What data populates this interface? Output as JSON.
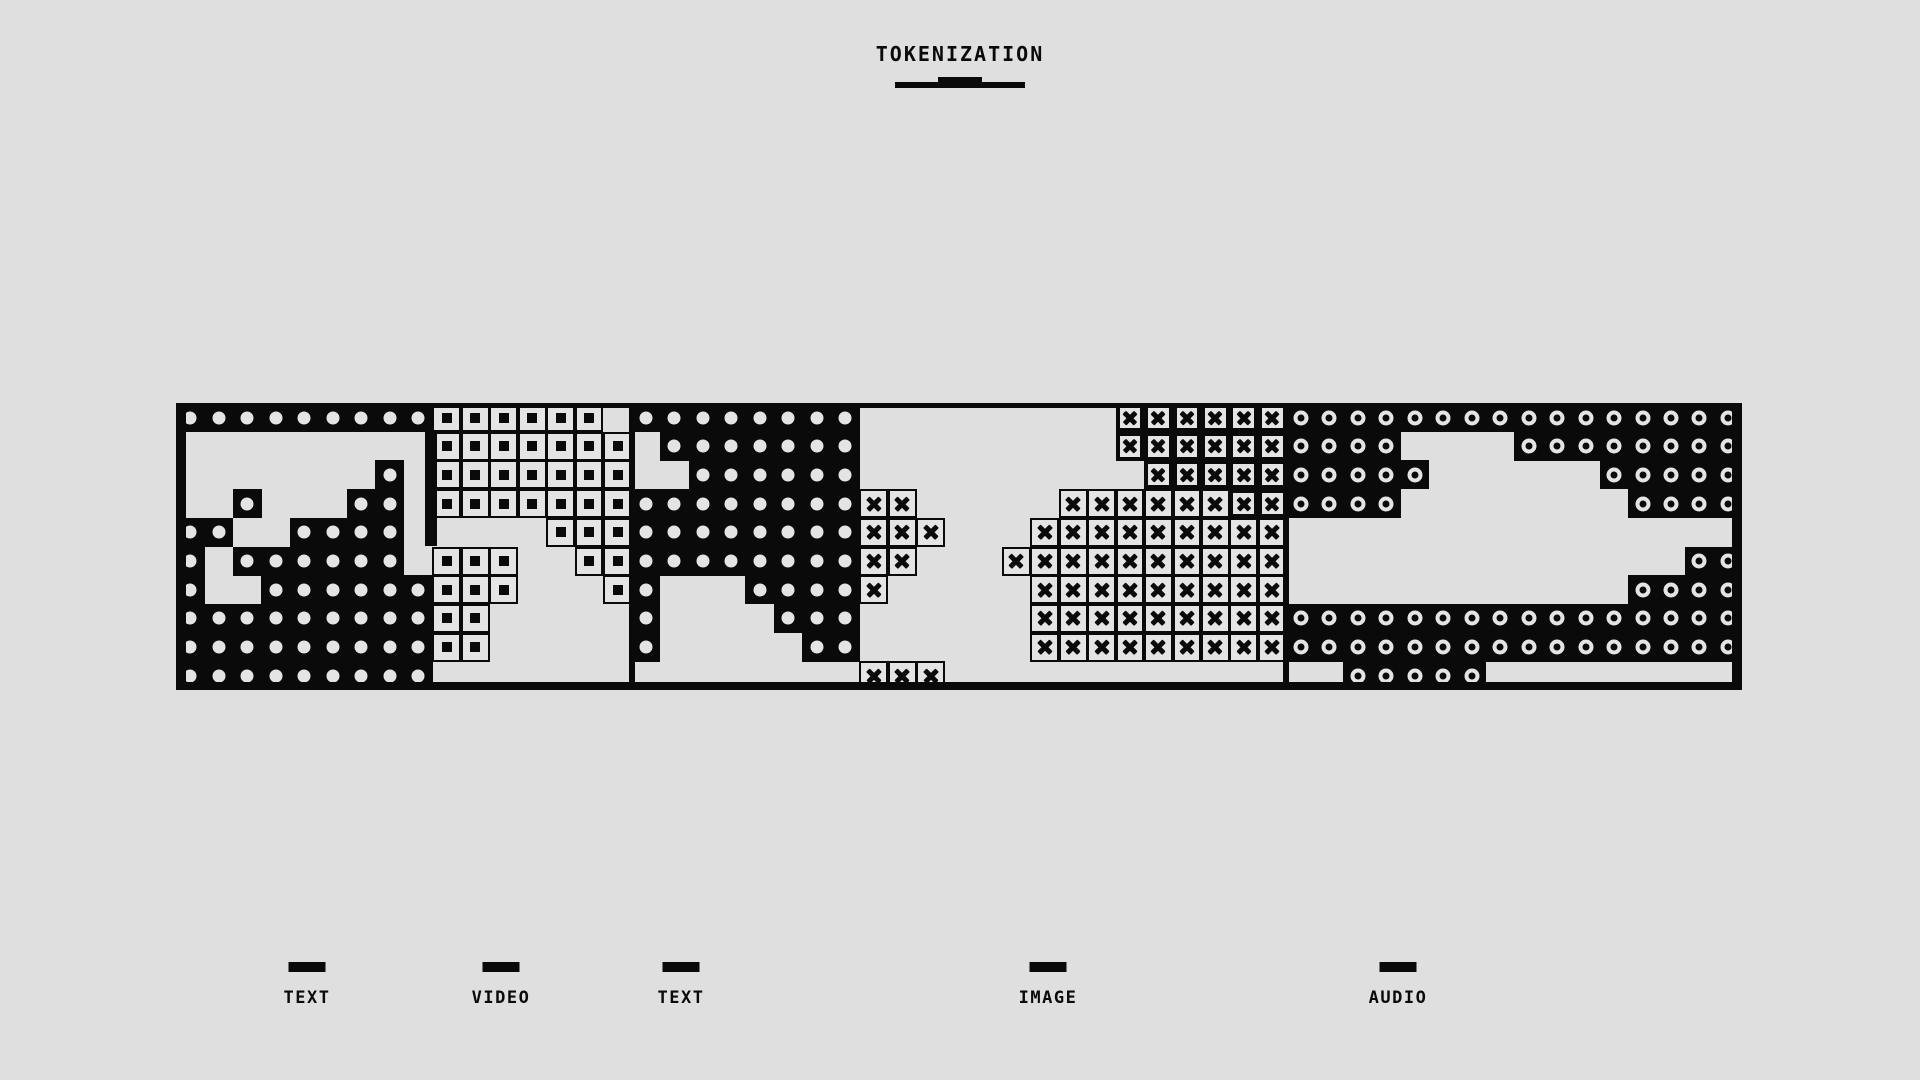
{
  "title": "TOKENIZATION",
  "colors": {
    "background": "#dfdfdf",
    "ink": "#0a0a0a",
    "token_fill": "#e4e4e4"
  },
  "strip": {
    "left": 176,
    "top": 403,
    "width": 1566,
    "height": 287,
    "cols": 55,
    "rows": 10,
    "legend": {
      "D": "text-token-dot",
      "S": "video-token-square",
      "X": "image-token-x",
      "Y": "image-token-x-on-black",
      "O": "audio-token-ring",
      ".": "empty-background"
    },
    "map": [
      "DDDDDDDDDSSSSSS.DDDDDDDD.........YYYYYYOOOOOOOOOOOOOOOO",
      ".........SSSSSSS.DDDDDDD.........YYYYYYOOOO....OOOOOOOO",
      ".......D.SSSSSSS..DDDDDD..........YYYYYOOOOO......OOOOO",
      "..D...DD.SSSSSSSDDDDDDDDXX.....XXXXXXYYOOOO........OOOO",
      "DD..DDDD.....SSSDDDDDDDDXXX...XXXXXXXXX................",
      "D.DDDDDD.SSS..SSDDDDDDDDXX...XXXXXXXXXX..............OO",
      "D..DDDDDDSSS...SD...DDDDX.....XXXXXXXXX............OOOO",
      "DDDDDDDDDSS.....D....DDD......XXXXXXXXXOOOOOOOOOOOOOOOO",
      "DDDDDDDDDSS.....D.....DD......XXXXXXXXXOOOOOOOOOOOOOOOO",
      "DDDDDDDDD...............XXX..............OOOOO........."
    ],
    "dividers": [
      {
        "x": 629,
        "width": 6
      },
      {
        "x": 1283,
        "width": 6
      }
    ],
    "edge_bands": [
      {
        "x": 425,
        "width": 12,
        "y": 29,
        "height": 114
      }
    ]
  },
  "segments": [
    {
      "name": "TEXT",
      "col_start": 0,
      "col_end": 8
    },
    {
      "name": "VIDEO",
      "col_start": 9,
      "col_end": 15
    },
    {
      "name": "TEXT",
      "col_start": 16,
      "col_end": 23
    },
    {
      "name": "IMAGE",
      "col_start": 24,
      "col_end": 38
    },
    {
      "name": "AUDIO",
      "col_start": 39,
      "col_end": 54
    }
  ],
  "labels": [
    {
      "text": "TEXT",
      "x": 307
    },
    {
      "text": "VIDEO",
      "x": 501
    },
    {
      "text": "TEXT",
      "x": 681
    },
    {
      "text": "IMAGE",
      "x": 1048
    },
    {
      "text": "AUDIO",
      "x": 1398
    }
  ]
}
